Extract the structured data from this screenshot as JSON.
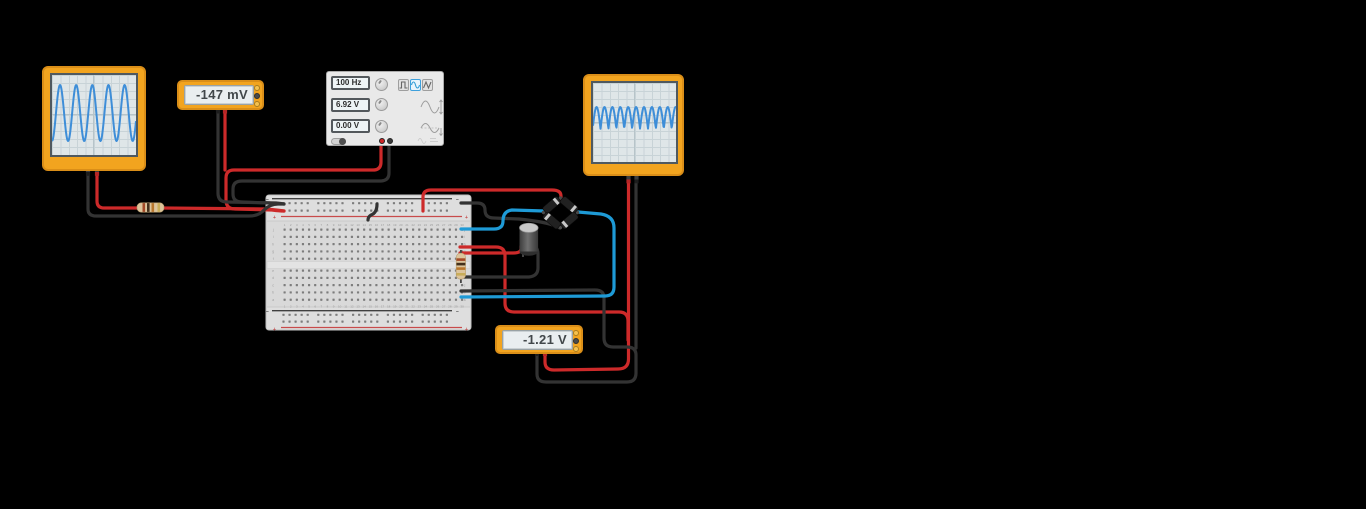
{
  "stage": {
    "background": "#000000"
  },
  "colors": {
    "wire_red": "#cd2a2a",
    "wire_black": "#333333",
    "wire_blue": "#1e9ad6",
    "device_body": "#f2a41f",
    "screen": "#dfe6e8",
    "trace": "#3e8ed8"
  },
  "left_scope": {
    "time_label": "50.0 ms",
    "volts_label": "6.9 V",
    "trace": {
      "type": "sine",
      "cycles": 5.2,
      "center": 38,
      "amplitude": 28,
      "phase": -1.55
    }
  },
  "right_scope": {
    "time_label": "50.0 ms",
    "volts_label": "6.9 V",
    "trace": {
      "type": "rectified",
      "humps": 10.5,
      "baseline": 46,
      "height": 22,
      "phase": 0.15
    }
  },
  "multimeter_top": {
    "value": "-147 mV"
  },
  "multimeter_bottom": {
    "value": "-1.21 V"
  },
  "function_generator": {
    "frequency": "100 Hz",
    "amplitude": "6.92 V",
    "dc_offset": "0.00 V",
    "waveform_options": [
      "square",
      "sine",
      "triangle"
    ],
    "selected_waveform": "sine"
  },
  "breadboard": {
    "columns": 30,
    "top_row_letters": [
      "j",
      "i",
      "h",
      "g",
      "f"
    ],
    "bottom_row_letters": [
      "e",
      "d",
      "c",
      "b",
      "a"
    ],
    "plus": "+",
    "minus": "−"
  }
}
